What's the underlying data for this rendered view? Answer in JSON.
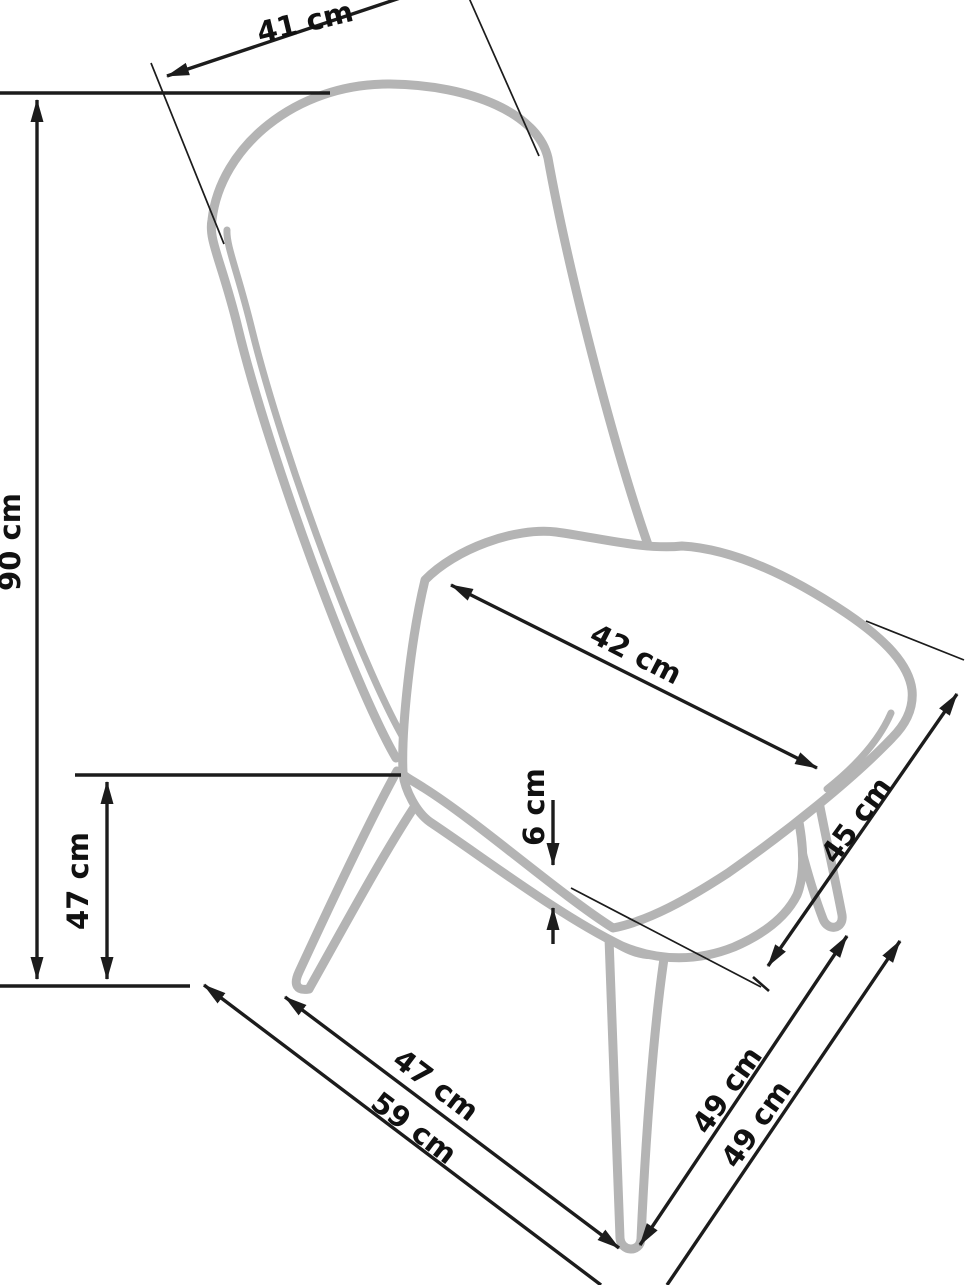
{
  "diagram": {
    "type": "chair-dimension-drawing",
    "unit": "cm",
    "background_color": "#ffffff",
    "dimension_line_color": "#1c1c1c",
    "chair_outline_color": "#b4b4b4",
    "measurements": {
      "backrest_width": {
        "label": "41 cm",
        "value": 41
      },
      "total_height": {
        "label": "90 cm",
        "value": 90
      },
      "seat_height": {
        "label": "47 cm",
        "value": 47
      },
      "seat_width": {
        "label": "42 cm",
        "value": 42
      },
      "cushion_thickness": {
        "label": "6 cm",
        "value": 6
      },
      "seat_depth": {
        "label": "45 cm",
        "value": 45
      },
      "base_depth_front": {
        "label": "47 cm",
        "value": 47
      },
      "base_depth_total": {
        "label": "59 cm",
        "value": 59
      },
      "leg_span_right": {
        "label": "49 cm",
        "value": 49
      },
      "leg_span_right_2": {
        "label": "49 cm",
        "value": 49
      }
    }
  }
}
